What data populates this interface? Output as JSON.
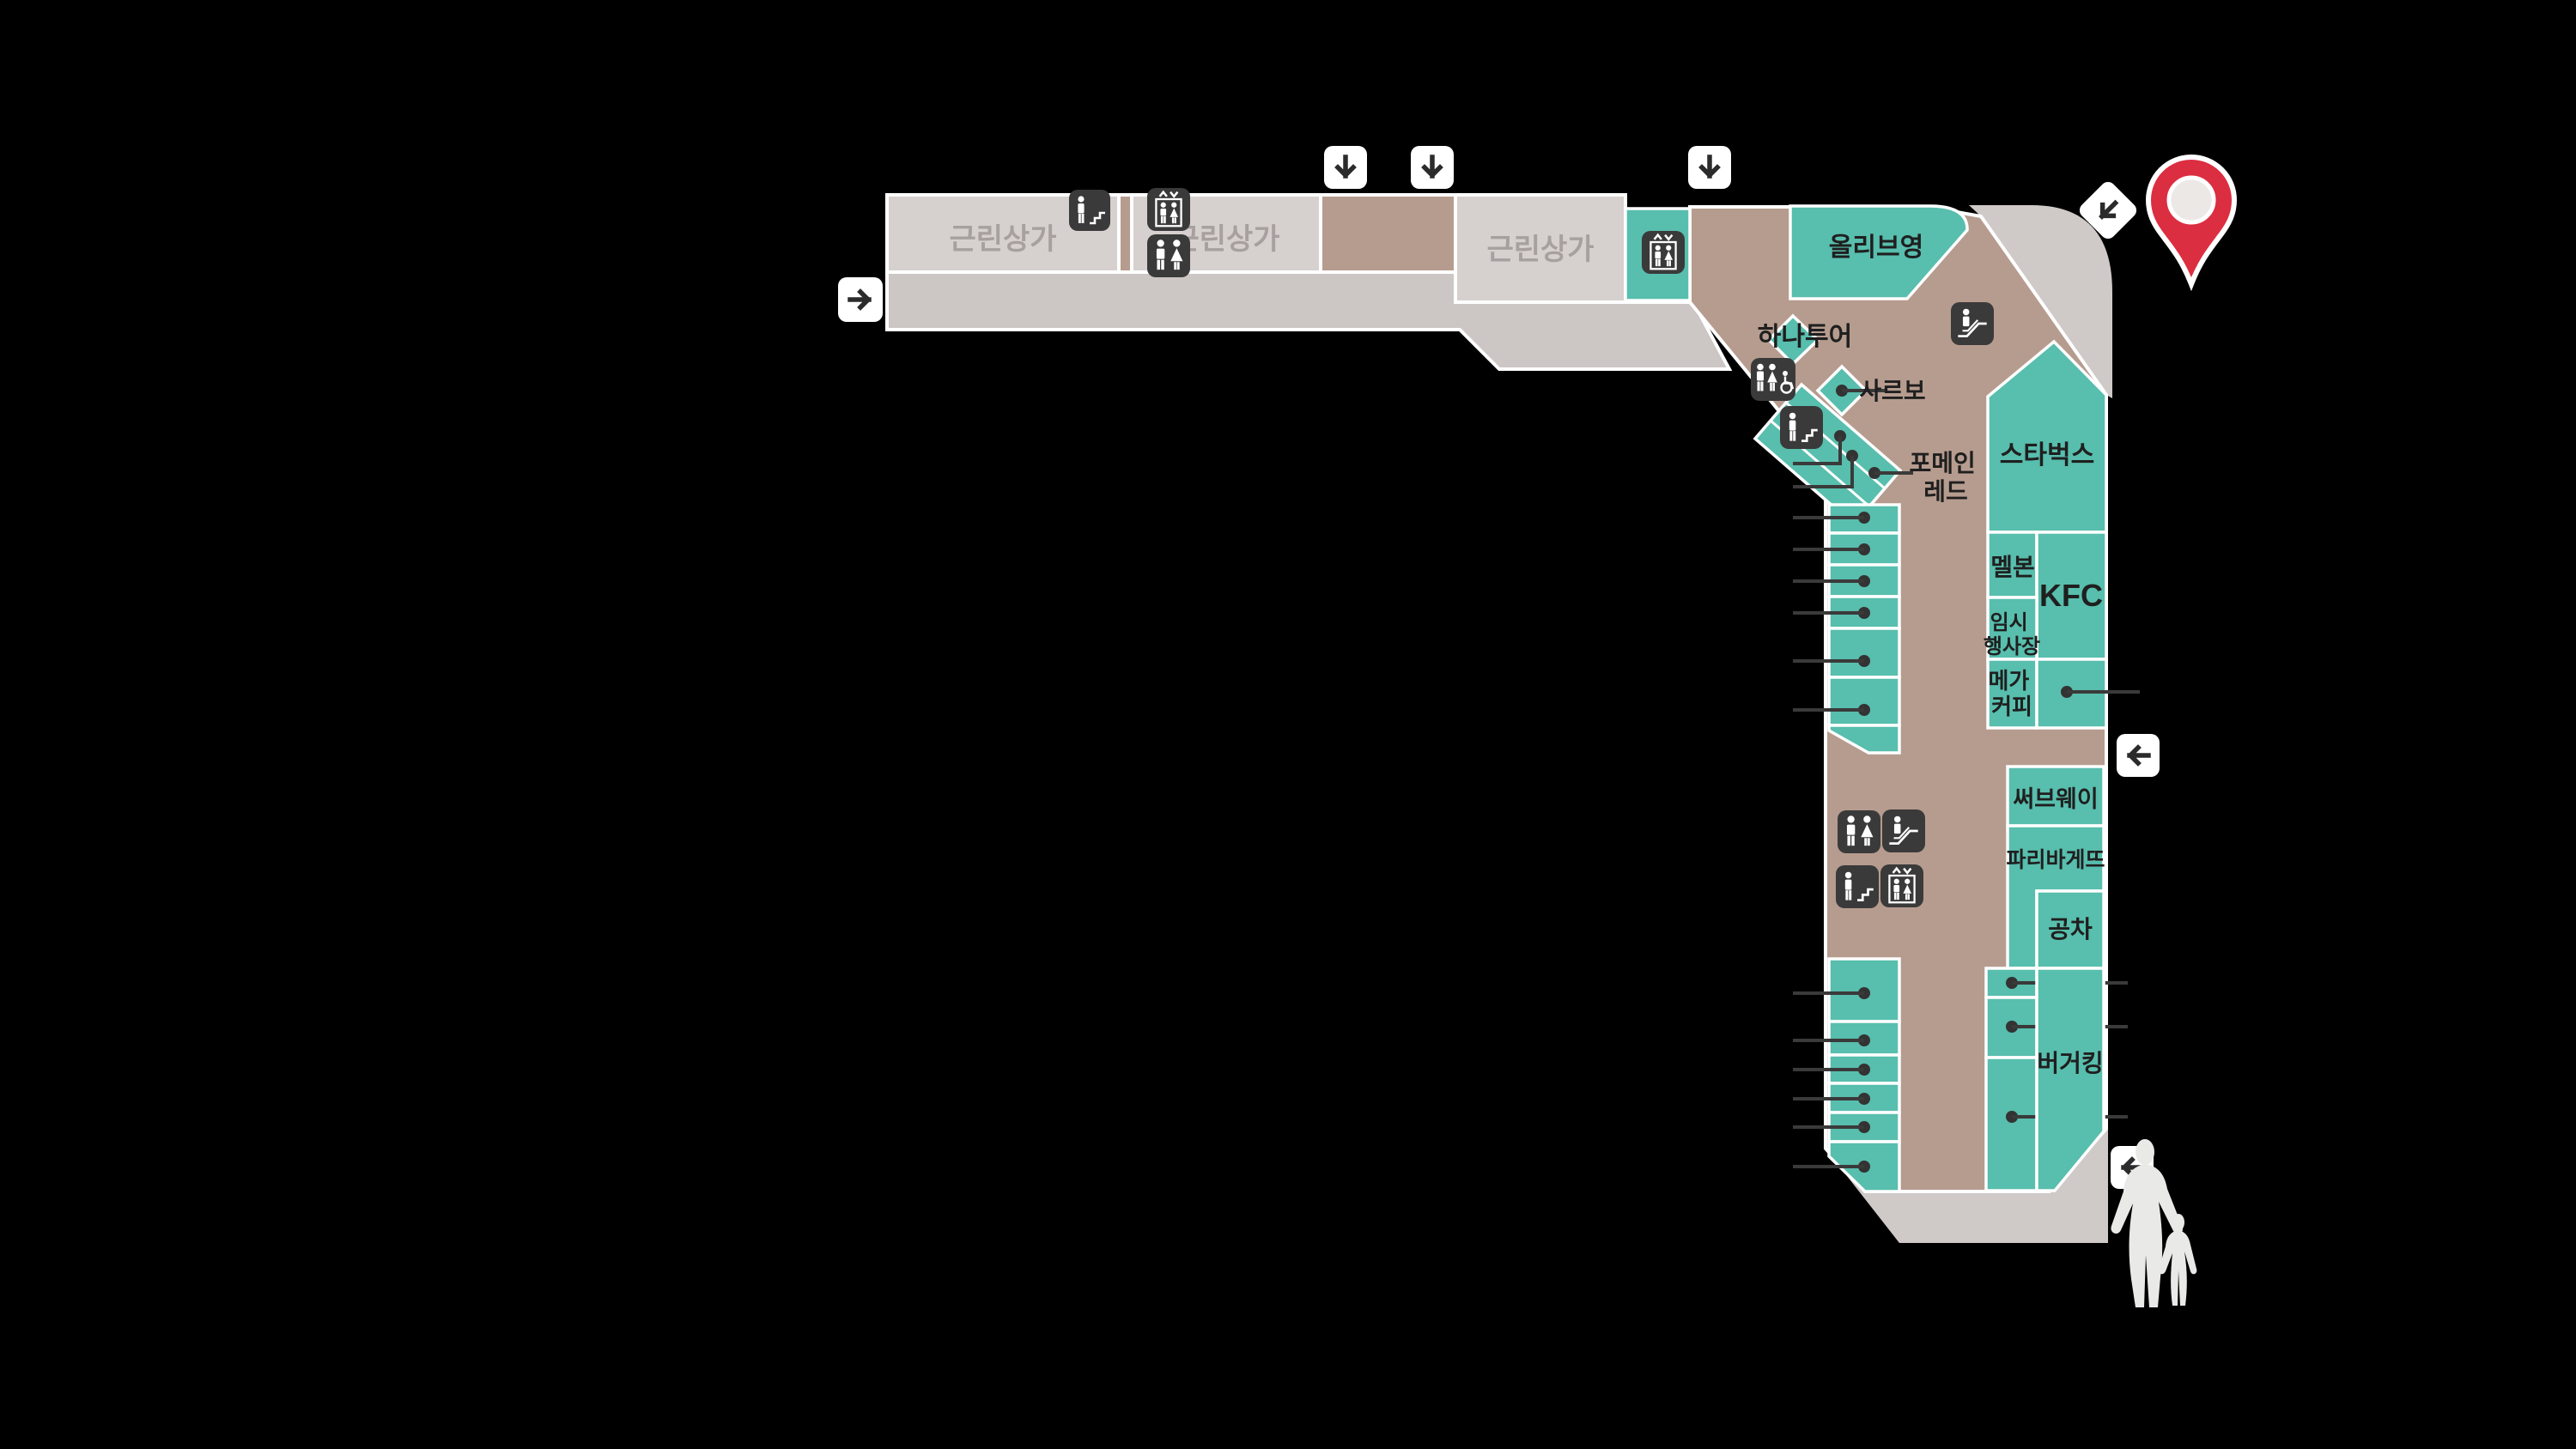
{
  "stores": {
    "neighborhood_a": "근린상가",
    "neighborhood_b": "근린상가",
    "neighborhood_c": "근린상가",
    "olive_young": "올리브영",
    "hana_tour": "하나투어",
    "sarbo": "사르보",
    "phomein_line1": "포메인",
    "phomein_line2": "레드",
    "starbucks": "스타벅스",
    "melbon": "멜본",
    "kfc": "KFC",
    "temp_event_line1": "임시",
    "temp_event_line2": "행사장",
    "mega_coffee_line1": "메가",
    "mega_coffee_line2": "커피",
    "subway": "써브웨이",
    "paris_baguette": "파리바게뜨",
    "gong_cha": "공차",
    "burger_king": "버거킹"
  },
  "icons": {
    "restroom": "restroom-icon",
    "accessible_restroom": "accessible-restroom-icon",
    "elevator": "elevator-icon",
    "escalator": "escalator-icon",
    "stairs": "stairs-icon",
    "location_pin": "location-pin-icon",
    "arrow_down": "down-arrow-icon",
    "arrow_left": "left-arrow-icon",
    "arrow_right": "right-arrow-icon",
    "arrow_down_left": "down-left-arrow-icon",
    "people": "pedestrians-silhouette"
  },
  "colors": {
    "background": "#000000",
    "store_teal": "#58bead",
    "corridor_tan": "#b69c8f",
    "block_gray": "#d6d0cf",
    "corridor_gray": "#ccc6c5",
    "exterior_gray": "#cfc9c8",
    "icon_background": "#3a3a3a",
    "pin_red": "#dc2e41",
    "silhouette": "#e9e9e7",
    "label_dark": "#1f1f1f",
    "label_gray": "#a7a09f"
  }
}
